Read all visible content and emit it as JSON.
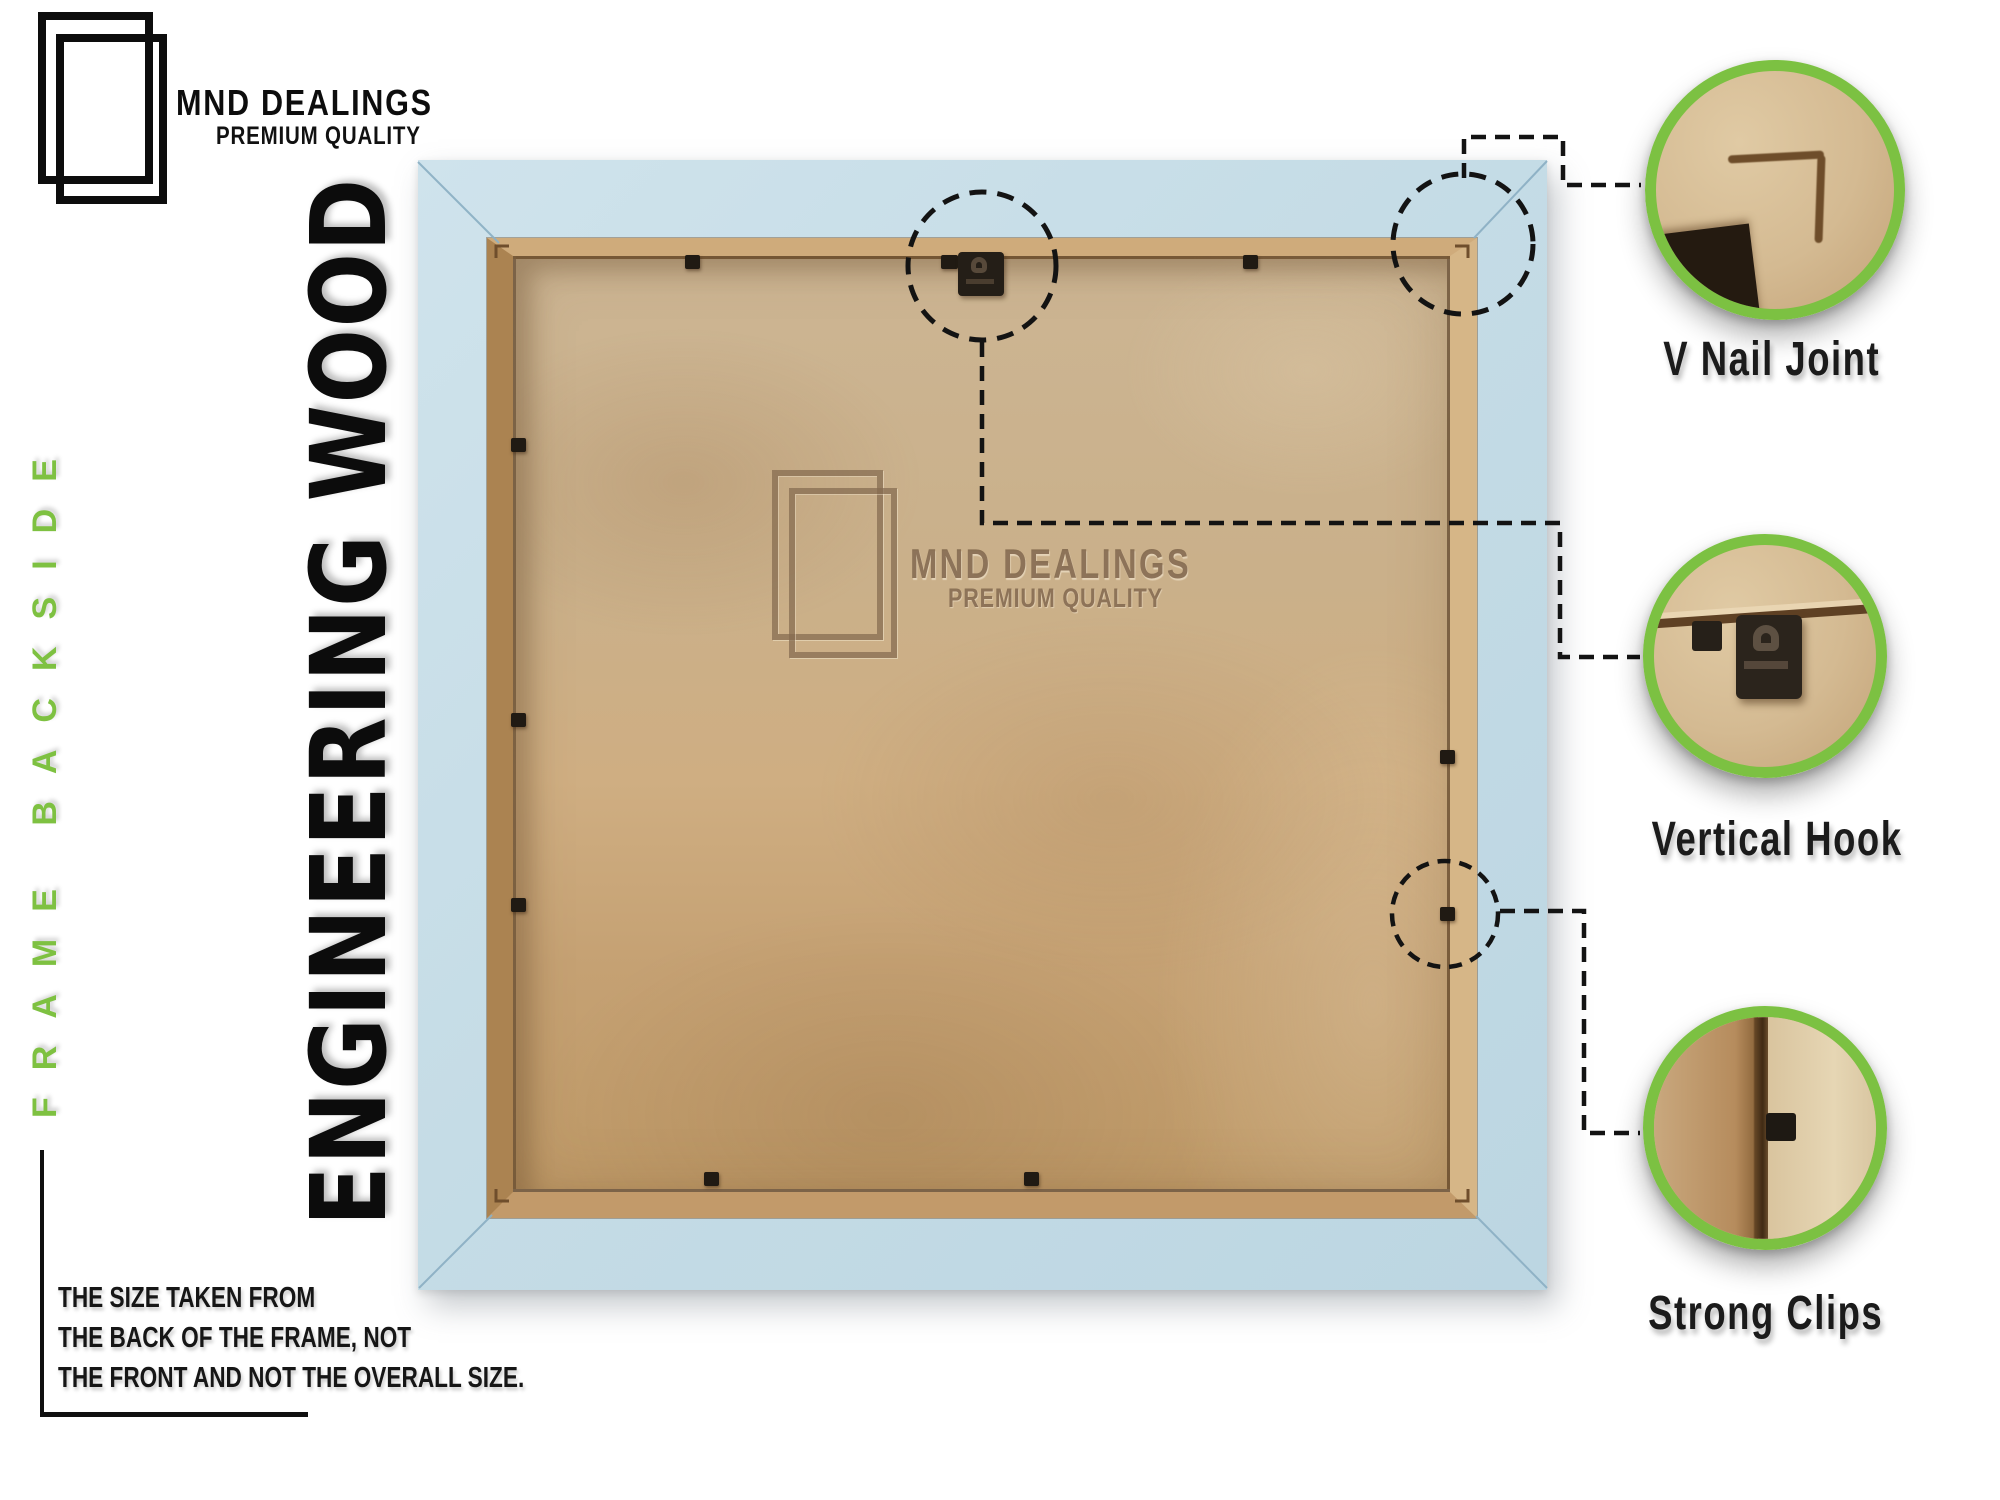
{
  "brand": {
    "name": "MND DEALINGS",
    "tagline": "PREMIUM QUALITY"
  },
  "side_label": "FRAME BACKSIDE",
  "material_label": "ENGINEERING WOOD",
  "watermark": {
    "name": "MND DEALINGS",
    "tagline": "PREMIUM QUALITY"
  },
  "note": {
    "lines": [
      "THE SIZE TAKEN FROM",
      "THE BACK OF THE FRAME, NOT",
      "THE FRONT AND NOT THE OVERALL SIZE."
    ]
  },
  "callouts": [
    {
      "id": "v-nail-joint",
      "label": "V Nail Joint"
    },
    {
      "id": "vertical-hook",
      "label": "Vertical Hook"
    },
    {
      "id": "strong-clips",
      "label": "Strong Clips"
    }
  ],
  "colors": {
    "accent_green": "#7cc142",
    "side_green": "#7ec141",
    "ink": "#141414",
    "frame_blue": "#c5dce6",
    "frame_blue_light": "#cfe3ec",
    "frame_blue_dark": "#bcd6e2",
    "lip_wood": "#cfab7b",
    "mdf_light": "#cdb795",
    "mdf_dark": "#bf9a68",
    "watermark_brown": "#8a6f57"
  }
}
